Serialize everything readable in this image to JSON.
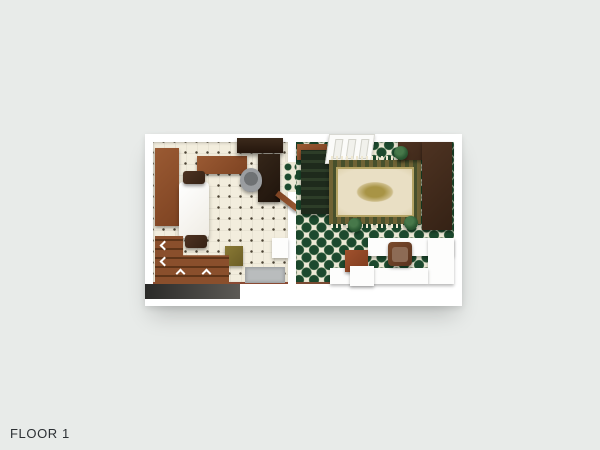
{
  "floorplan": {
    "label": "FLOOR 1",
    "view": "3d-top-down-render",
    "rooms": [
      {
        "id": "kitchen-dining",
        "floor_pattern": "cream-tile-with-dark-diamond-dots"
      },
      {
        "id": "living-hall",
        "floor_pattern": "green-diamond-lattice-tile"
      }
    ],
    "furniture": [
      "left-wall-cabinet",
      "sideboard",
      "wall-shelf",
      "desk",
      "office-chair",
      "dining-table",
      "dining-chair-north",
      "dining-chair-south",
      "radiator",
      "stool-box",
      "doormat",
      "staircase-with-up-arrows",
      "divider-open-door",
      "vestibule-cabinet",
      "dark-stairwell",
      "entry-panel-door",
      "ornate-rug",
      "wardrobe-top",
      "wardrobe-side",
      "plant-pot-1",
      "plant-pot-2",
      "plant-pot-3",
      "bathroom-partition",
      "armchair",
      "terracotta-cabinet",
      "white-box"
    ]
  },
  "colors": {
    "bg": "#e8ebe9",
    "wall": "#ffffff",
    "kitchen_floor": "#f2eddd",
    "dot": "#4b4334",
    "tile_bg": "#ece9d6",
    "tile_green": "#1c492e",
    "wood": "#9a5a33",
    "wood_dark": "#4e3322",
    "rug_field": "#e9dfc4",
    "rug_border": "#6f6335",
    "plant": "#2c5a34",
    "mat_gray": "#b9bcbd",
    "label_text": "#2c3034"
  }
}
